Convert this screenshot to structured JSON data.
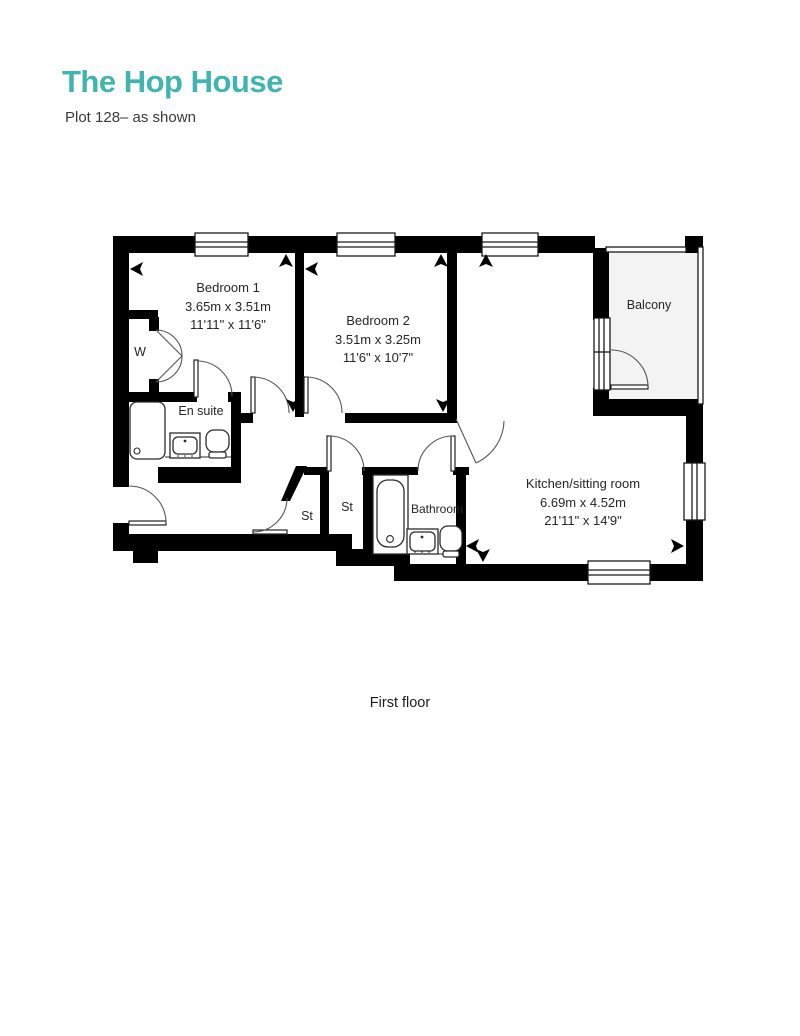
{
  "page": {
    "title": "The Hop House",
    "subtitle": "Plot 128– as shown",
    "caption": "First floor"
  },
  "colors": {
    "accent": "#40b5af",
    "walls": "#000000",
    "text": "#262626"
  },
  "rooms": {
    "bedroom1": {
      "name": "Bedroom 1",
      "metric": "3.65m x 3.51m",
      "imperial": "11'11\" x 11'6\""
    },
    "bedroom2": {
      "name": "Bedroom 2",
      "metric": "3.51m x 3.25m",
      "imperial": "11'6\" x 10'7\""
    },
    "kitchen": {
      "name": "Kitchen/sitting room",
      "metric": "6.69m x 4.52m",
      "imperial": "21'11\" x 14'9\""
    },
    "balcony": {
      "name": "Balcony"
    },
    "ensuite": {
      "name": "En suite"
    },
    "bathroom": {
      "name": "Bathroom"
    },
    "wardrobe": {
      "name": "W"
    },
    "store1": {
      "name": "St"
    },
    "store2": {
      "name": "St"
    }
  }
}
